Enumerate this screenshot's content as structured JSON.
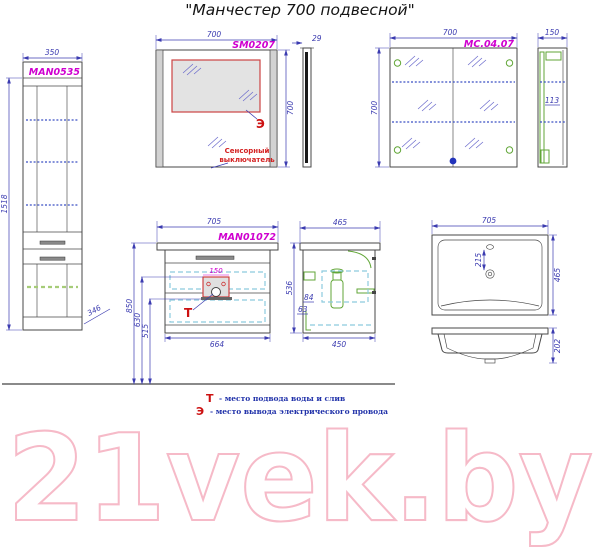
{
  "title": "\"Манчестер 700 подвесной\"",
  "colors": {
    "dimension": "#3b3bb0",
    "label": "#cf00cf",
    "marker_red": "#cc1111",
    "green_detail": "#61a637",
    "shelf_blue": "#3b4fc4",
    "drawer_cyan": "#8ccade",
    "watermark_pink": "#f6bac8",
    "outline": "#474747"
  },
  "tall_cabinet": {
    "label": "MAN0535",
    "width_mm": "350",
    "height_mm": "1518",
    "depth_mm": "346"
  },
  "mirror": {
    "label": "SM0207",
    "width_mm": "700",
    "height_mm": "700",
    "thickness_mm": "29",
    "marker": "Э",
    "switch_note_line1": "Сенсорный",
    "switch_note_line2": "выключатель"
  },
  "mirror_cabinet": {
    "label": "MC.04.07",
    "width_mm": "700",
    "height_mm": "700",
    "side_depth_mm": "150",
    "inner_depth_mm": "113"
  },
  "vanity": {
    "label": "MAN01072",
    "width_mm": "705",
    "cutout_width_mm": "150",
    "marker": "Т",
    "height_floor_to_top_mm": "850",
    "height_cutout_mm": "630",
    "height_bottom_mm": "515",
    "body_width_mm": "664",
    "side_height_mm": "536",
    "side_top_depth_mm": "465",
    "side_bottom_depth_mm": "450",
    "drain_dim_a_mm": "84",
    "drain_dim_b_mm": "63"
  },
  "sink": {
    "width_mm": "705",
    "depth_mm": "465",
    "faucet_to_drain_mm": "215",
    "front_height_mm": "202"
  },
  "legend": {
    "t_symbol": "Т",
    "t_text": "- место подвода воды и слив",
    "e_symbol": "Э",
    "e_text": "- место вывода электрического провода"
  },
  "watermark": "21vek.by"
}
